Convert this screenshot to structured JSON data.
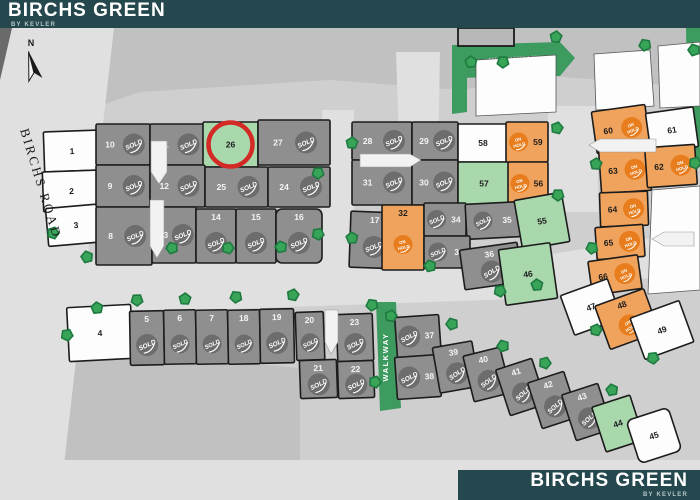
{
  "header": {
    "title": "BIRCHS GREEN",
    "subtitle": "BY KEVLER"
  },
  "footer": {
    "title": "BIRCHS GREEN",
    "subtitle": "BY KEVLER"
  },
  "map": {
    "road_label": "BIRCHS ROAD",
    "walkway_top_label": "WALKWAY",
    "walkway_vertical_label": "WALKWAY",
    "north_label": "N",
    "sold_label": "SOLD",
    "on_hold_label": "ON HOLD",
    "highlighted_lot": "26",
    "colors": {
      "teal": "#25484e",
      "bar_text": "#ffffff",
      "bar_subtext": "#b7c6c8",
      "map_bg": "#cfcfcf",
      "band": "#c1c1c1",
      "road": "#e0e0e0",
      "wedge": "#6a6a6a",
      "lot_sold": "#8f8f8f",
      "badge_sold": "#6d6d6d",
      "lot_hold": "#f0a35c",
      "badge_hold": "#e87d1d",
      "lot_green": "#a9d8ad",
      "lot_white": "#fdfdfd",
      "walkway": "#3d9b5f",
      "tree": "#38a457",
      "tree_border": "#1e7a40",
      "outline": "#1c1c1c",
      "highlight": "#d42a26",
      "number_dark": "#1d1d1d",
      "number_light": "#f4f4f4",
      "building": "#b8b8b8"
    },
    "bands": [
      [
        [
          0,
          28
        ],
        [
          700,
          28
        ],
        [
          700,
          88
        ],
        [
          552,
          76
        ],
        [
          460,
          90
        ],
        [
          330,
          80
        ],
        [
          140,
          92
        ],
        [
          64,
          118
        ],
        [
          0,
          142
        ]
      ],
      [
        [
          28,
          342
        ],
        [
          300,
          368
        ],
        [
          300,
          462
        ],
        [
          0,
          468
        ],
        [
          0,
          400
        ]
      ]
    ],
    "roads": [
      [
        [
          4,
          28
        ],
        [
          114,
          28
        ],
        [
          60,
          500
        ],
        [
          -40,
          500
        ]
      ],
      [
        [
          30,
          260
        ],
        [
          540,
          256
        ],
        [
          700,
          230
        ],
        [
          700,
          268
        ],
        [
          545,
          298
        ],
        [
          30,
          316
        ]
      ],
      [
        [
          322,
          110
        ],
        [
          354,
          110
        ],
        [
          354,
          266
        ],
        [
          322,
          266
        ]
      ],
      [
        [
          396,
          52
        ],
        [
          440,
          52
        ],
        [
          438,
          170
        ],
        [
          400,
          170
        ]
      ],
      [
        [
          548,
          106
        ],
        [
          598,
          106
        ],
        [
          598,
          212
        ],
        [
          548,
          212
        ]
      ],
      [
        [
          0,
          460
        ],
        [
          700,
          460
        ],
        [
          700,
          500
        ],
        [
          0,
          500
        ]
      ]
    ],
    "corner_wedge": [
      [
        0,
        28
      ],
      [
        12,
        28
      ],
      [
        0,
        80
      ]
    ],
    "walkways": [
      {
        "pts": [
          [
            452,
            45
          ],
          [
            560,
            42
          ],
          [
            575,
            58
          ],
          [
            560,
            76
          ],
          [
            452,
            78
          ]
        ],
        "label": "top",
        "lx": 514,
        "ly": 62,
        "rot": -3
      },
      {
        "pts": [
          [
            452,
            45
          ],
          [
            467,
            45
          ],
          [
            467,
            112
          ],
          [
            452,
            114
          ]
        ]
      },
      {
        "pts": [
          [
            686,
            28
          ],
          [
            700,
            28
          ],
          [
            700,
            167
          ],
          [
            688,
            167
          ]
        ]
      },
      {
        "pts": [
          [
            376,
            302
          ],
          [
            396,
            302
          ],
          [
            401,
            408
          ],
          [
            380,
            411
          ]
        ],
        "label": "vertical",
        "lx": 388,
        "ly": 357,
        "rot": -90
      }
    ],
    "parcels": [
      [
        [
          476,
          60
        ],
        [
          556,
          55
        ],
        [
          556,
          112
        ],
        [
          476,
          116
        ]
      ],
      [
        [
          594,
          54
        ],
        [
          650,
          50
        ],
        [
          654,
          106
        ],
        [
          596,
          110
        ]
      ],
      [
        [
          658,
          46
        ],
        [
          700,
          42
        ],
        [
          700,
          106
        ],
        [
          660,
          108
        ]
      ],
      [
        [
          652,
          190
        ],
        [
          700,
          186
        ],
        [
          700,
          290
        ],
        [
          648,
          294
        ]
      ]
    ],
    "building": {
      "x": 458,
      "y": 28,
      "w": 56,
      "h": 18
    },
    "arrows": [
      [
        [
          151,
          141
        ],
        [
          167,
          141
        ],
        [
          167,
          172
        ],
        [
          159,
          184
        ],
        [
          151,
          172
        ]
      ],
      [
        [
          150,
          200
        ],
        [
          164,
          200
        ],
        [
          164,
          246
        ],
        [
          157,
          258
        ],
        [
          150,
          246
        ]
      ],
      [
        [
          360,
          154
        ],
        [
          410,
          154
        ],
        [
          421,
          160
        ],
        [
          410,
          167
        ],
        [
          360,
          167
        ]
      ],
      [
        [
          325,
          310
        ],
        [
          338,
          310
        ],
        [
          338,
          342
        ],
        [
          331,
          354
        ],
        [
          325,
          342
        ]
      ],
      [
        [
          589,
          145
        ],
        [
          600,
          139
        ],
        [
          656,
          139
        ],
        [
          656,
          152
        ],
        [
          600,
          152
        ]
      ],
      [
        [
          652,
          239
        ],
        [
          664,
          232
        ],
        [
          694,
          232
        ],
        [
          694,
          246
        ],
        [
          664,
          246
        ]
      ]
    ],
    "trees": [
      [
        53,
        233
      ],
      [
        87,
        257
      ],
      [
        67,
        335
      ],
      [
        97,
        308
      ],
      [
        137,
        300
      ],
      [
        185,
        299
      ],
      [
        236,
        297
      ],
      [
        293,
        295
      ],
      [
        172,
        248
      ],
      [
        228,
        248
      ],
      [
        281,
        247
      ],
      [
        318,
        234
      ],
      [
        352,
        238
      ],
      [
        318,
        173
      ],
      [
        352,
        143
      ],
      [
        372,
        305
      ],
      [
        391,
        316
      ],
      [
        452,
        324
      ],
      [
        375,
        382
      ],
      [
        430,
        266
      ],
      [
        500,
        291
      ],
      [
        537,
        285
      ],
      [
        558,
        195
      ],
      [
        596,
        164
      ],
      [
        592,
        248
      ],
      [
        596,
        330
      ],
      [
        503,
        346
      ],
      [
        545,
        363
      ],
      [
        612,
        390
      ],
      [
        653,
        358
      ],
      [
        471,
        62
      ],
      [
        503,
        62
      ],
      [
        556,
        37
      ],
      [
        645,
        45
      ],
      [
        557,
        128
      ],
      [
        694,
        50
      ],
      [
        695,
        163
      ]
    ],
    "highlight_circle": {
      "cx": 230.5,
      "cy": 144.5,
      "r": 22
    },
    "north": {
      "x": 26,
      "y": 40
    },
    "road_label_pos": {
      "x": 20,
      "y": 130,
      "rot": 73
    },
    "lots": [
      {
        "n": "1",
        "s": "white",
        "x": 44,
        "y": 131,
        "w": 56,
        "h": 40,
        "r": -2,
        "m": "c"
      },
      {
        "n": "2",
        "s": "white",
        "x": 43,
        "y": 171,
        "w": 57,
        "h": 40,
        "r": -2,
        "m": "c"
      },
      {
        "n": "3",
        "s": "white",
        "x": 47,
        "y": 206,
        "w": 58,
        "h": 38,
        "r": -5,
        "m": "c"
      },
      {
        "n": "4",
        "s": "white",
        "x": 68,
        "y": 306,
        "w": 64,
        "h": 54,
        "r": -3,
        "m": "c"
      },
      {
        "n": "10",
        "s": "sold",
        "x": 96,
        "y": 124,
        "w": 54,
        "h": 41,
        "r": 0,
        "m": "l"
      },
      {
        "n": "11",
        "s": "sold",
        "x": 150,
        "y": 124,
        "w": 55,
        "h": 41,
        "r": 0,
        "m": "l"
      },
      {
        "n": "26",
        "s": "green",
        "x": 203,
        "y": 122,
        "w": 55,
        "h": 45,
        "r": 0,
        "m": "c"
      },
      {
        "n": "27",
        "s": "sold",
        "x": 258,
        "y": 120,
        "w": 72,
        "h": 45,
        "r": 0,
        "m": "l"
      },
      {
        "n": "9",
        "s": "sold",
        "x": 96,
        "y": 165,
        "w": 54,
        "h": 42,
        "r": 0,
        "m": "l"
      },
      {
        "n": "12",
        "s": "sold",
        "x": 150,
        "y": 165,
        "w": 55,
        "h": 42,
        "r": 0,
        "m": "l"
      },
      {
        "n": "25",
        "s": "sold",
        "x": 205,
        "y": 167,
        "w": 63,
        "h": 40,
        "r": 0,
        "m": "l"
      },
      {
        "n": "24",
        "s": "sold",
        "x": 268,
        "y": 167,
        "w": 62,
        "h": 40,
        "r": 0,
        "m": "l"
      },
      {
        "n": "28",
        "s": "sold",
        "x": 352,
        "y": 122,
        "w": 60,
        "h": 38,
        "r": 0,
        "m": "l"
      },
      {
        "n": "29",
        "s": "sold",
        "x": 412,
        "y": 122,
        "w": 46,
        "h": 38,
        "r": 0,
        "m": "l"
      },
      {
        "n": "31",
        "s": "sold",
        "x": 352,
        "y": 160,
        "w": 60,
        "h": 45,
        "r": 0,
        "m": "l"
      },
      {
        "n": "30",
        "s": "sold",
        "x": 412,
        "y": 160,
        "w": 46,
        "h": 45,
        "r": 0,
        "m": "l"
      },
      {
        "n": "58",
        "s": "white",
        "x": 458,
        "y": 124,
        "w": 50,
        "h": 38,
        "r": 0,
        "m": "c"
      },
      {
        "n": "57",
        "s": "green",
        "x": 458,
        "y": 162,
        "w": 52,
        "h": 43,
        "r": 0,
        "m": "c"
      },
      {
        "n": "59",
        "s": "hold",
        "x": 506,
        "y": 122,
        "w": 42,
        "h": 40,
        "r": 0,
        "m": "r"
      },
      {
        "n": "56",
        "s": "hold",
        "x": 508,
        "y": 162,
        "w": 40,
        "h": 43,
        "r": 0,
        "m": "r"
      },
      {
        "n": "60",
        "s": "hold",
        "x": 594,
        "y": 108,
        "w": 54,
        "h": 42,
        "r": -8,
        "m": "l"
      },
      {
        "n": "61",
        "s": "white",
        "x": 648,
        "y": 110,
        "w": 48,
        "h": 40,
        "r": -8,
        "m": "c"
      },
      {
        "n": "63",
        "s": "hold",
        "x": 600,
        "y": 148,
        "w": 50,
        "h": 44,
        "r": -4,
        "m": "l"
      },
      {
        "n": "62",
        "s": "hold",
        "x": 646,
        "y": 146,
        "w": 50,
        "h": 40,
        "r": -4,
        "m": "l"
      },
      {
        "n": "64",
        "s": "hold",
        "x": 600,
        "y": 192,
        "w": 48,
        "h": 34,
        "r": -2,
        "m": "l"
      },
      {
        "n": "65",
        "s": "hold",
        "x": 596,
        "y": 226,
        "w": 48,
        "h": 32,
        "r": -4,
        "m": "l"
      },
      {
        "n": "66",
        "s": "hold",
        "x": 590,
        "y": 258,
        "w": 50,
        "h": 34,
        "r": -8,
        "m": "l"
      },
      {
        "n": "8",
        "s": "sold",
        "x": 96,
        "y": 207,
        "w": 56,
        "h": 58,
        "r": 0,
        "m": "l"
      },
      {
        "n": "13",
        "s": "sold",
        "x": 152,
        "y": 207,
        "w": 44,
        "h": 56,
        "r": 0,
        "m": "l"
      },
      {
        "n": "14",
        "s": "sold",
        "x": 196,
        "y": 209,
        "w": 40,
        "h": 54,
        "r": 0,
        "m": "t"
      },
      {
        "n": "15",
        "s": "sold",
        "x": 236,
        "y": 209,
        "w": 40,
        "h": 54,
        "r": 0,
        "m": "t"
      },
      {
        "n": "16",
        "s": "sold",
        "x": 276,
        "y": 209,
        "w": 46,
        "h": 54,
        "r": 0,
        "m": "t"
      },
      {
        "n": "17",
        "s": "sold",
        "x": 350,
        "y": 212,
        "w": 48,
        "h": 56,
        "r": 2,
        "m": "t"
      },
      {
        "n": "32",
        "s": "hold",
        "x": 382,
        "y": 205,
        "w": 42,
        "h": 65,
        "r": 0,
        "m": "t"
      },
      {
        "n": "34",
        "s": "sold",
        "x": 424,
        "y": 203,
        "w": 42,
        "h": 33,
        "r": 0,
        "m": "r"
      },
      {
        "n": "35",
        "s": "sold",
        "x": 466,
        "y": 203,
        "w": 54,
        "h": 35,
        "r": -3,
        "m": "r"
      },
      {
        "n": "33",
        "s": "sold",
        "x": 424,
        "y": 236,
        "w": 46,
        "h": 32,
        "r": 0,
        "m": "r"
      },
      {
        "n": "36",
        "s": "sold",
        "x": 462,
        "y": 246,
        "w": 58,
        "h": 40,
        "r": -8,
        "m": "t"
      },
      {
        "n": "55",
        "s": "green",
        "x": 518,
        "y": 196,
        "w": 48,
        "h": 50,
        "r": -10,
        "m": "c"
      },
      {
        "n": "46",
        "s": "green",
        "x": 502,
        "y": 246,
        "w": 52,
        "h": 56,
        "r": -8,
        "m": "c"
      },
      {
        "n": "47",
        "s": "white",
        "x": 566,
        "y": 286,
        "w": 50,
        "h": 42,
        "r": -20,
        "m": "c"
      },
      {
        "n": "48",
        "s": "hold",
        "x": 601,
        "y": 296,
        "w": 52,
        "h": 46,
        "r": -20,
        "m": "t"
      },
      {
        "n": "49",
        "s": "white",
        "x": 636,
        "y": 308,
        "w": 52,
        "h": 44,
        "r": -20,
        "m": "c"
      },
      {
        "n": "5",
        "s": "sold",
        "x": 130,
        "y": 311,
        "w": 34,
        "h": 54,
        "r": -1,
        "m": "t"
      },
      {
        "n": "6",
        "s": "sold",
        "x": 164,
        "y": 310,
        "w": 32,
        "h": 54,
        "r": -1,
        "m": "t"
      },
      {
        "n": "7",
        "s": "sold",
        "x": 196,
        "y": 310,
        "w": 32,
        "h": 54,
        "r": -1,
        "m": "t"
      },
      {
        "n": "18",
        "s": "sold",
        "x": 228,
        "y": 310,
        "w": 32,
        "h": 54,
        "r": -1,
        "m": "t"
      },
      {
        "n": "19",
        "s": "sold",
        "x": 260,
        "y": 309,
        "w": 34,
        "h": 54,
        "r": -1,
        "m": "t"
      },
      {
        "n": "20",
        "s": "sold",
        "x": 296,
        "y": 312,
        "w": 28,
        "h": 48,
        "r": -2,
        "m": "t"
      },
      {
        "n": "23",
        "s": "sold",
        "x": 337,
        "y": 314,
        "w": 36,
        "h": 47,
        "r": -2,
        "m": "t"
      },
      {
        "n": "21",
        "s": "sold",
        "x": 300,
        "y": 360,
        "w": 37,
        "h": 38,
        "r": -2,
        "m": "t"
      },
      {
        "n": "22",
        "s": "sold",
        "x": 338,
        "y": 361,
        "w": 36,
        "h": 37,
        "r": -2,
        "m": "t"
      },
      {
        "n": "37",
        "s": "sold",
        "x": 396,
        "y": 316,
        "w": 44,
        "h": 40,
        "r": -4,
        "m": "r"
      },
      {
        "n": "38",
        "s": "sold",
        "x": 396,
        "y": 356,
        "w": 44,
        "h": 42,
        "r": -4,
        "m": "r"
      },
      {
        "n": "39",
        "s": "sold",
        "x": 436,
        "y": 344,
        "w": 40,
        "h": 46,
        "r": -10,
        "m": "t"
      },
      {
        "n": "40",
        "s": "sold",
        "x": 468,
        "y": 351,
        "w": 38,
        "h": 47,
        "r": -14,
        "m": "t"
      },
      {
        "n": "41",
        "s": "sold",
        "x": 502,
        "y": 363,
        "w": 38,
        "h": 48,
        "r": -18,
        "m": "t"
      },
      {
        "n": "42",
        "s": "sold",
        "x": 534,
        "y": 376,
        "w": 38,
        "h": 48,
        "r": -18,
        "m": "t"
      },
      {
        "n": "43",
        "s": "sold",
        "x": 568,
        "y": 388,
        "w": 38,
        "h": 48,
        "r": -18,
        "m": "t"
      },
      {
        "n": "44",
        "s": "green",
        "x": 598,
        "y": 400,
        "w": 40,
        "h": 47,
        "r": -18,
        "m": "c"
      },
      {
        "n": "45",
        "s": "white",
        "x": 632,
        "y": 413,
        "w": 44,
        "h": 45,
        "r": -18,
        "m": "c"
      }
    ]
  }
}
